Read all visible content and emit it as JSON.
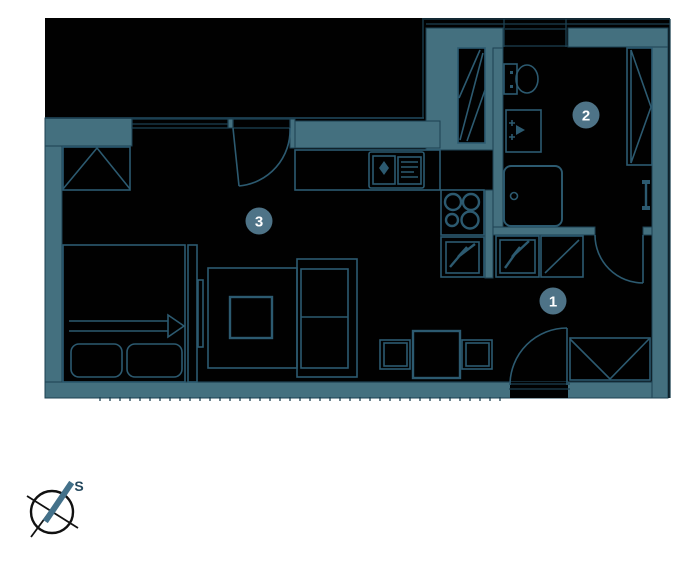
{
  "rooms": [
    {
      "label": "1"
    },
    {
      "label": "2"
    },
    {
      "label": "3"
    }
  ],
  "compass": {
    "label": "S"
  },
  "colors": {
    "wall_fill": "#44707f",
    "wall_line": "#1d4152",
    "furniture_line": "#2c5a70",
    "interior": "#010101",
    "badge_fill": "#4e7387",
    "badge_text": "#ffffff",
    "compass_outline": "#111111",
    "compass_needle": "#43718a",
    "compass_label": "#24485e",
    "page_bg": "#ffffff"
  }
}
